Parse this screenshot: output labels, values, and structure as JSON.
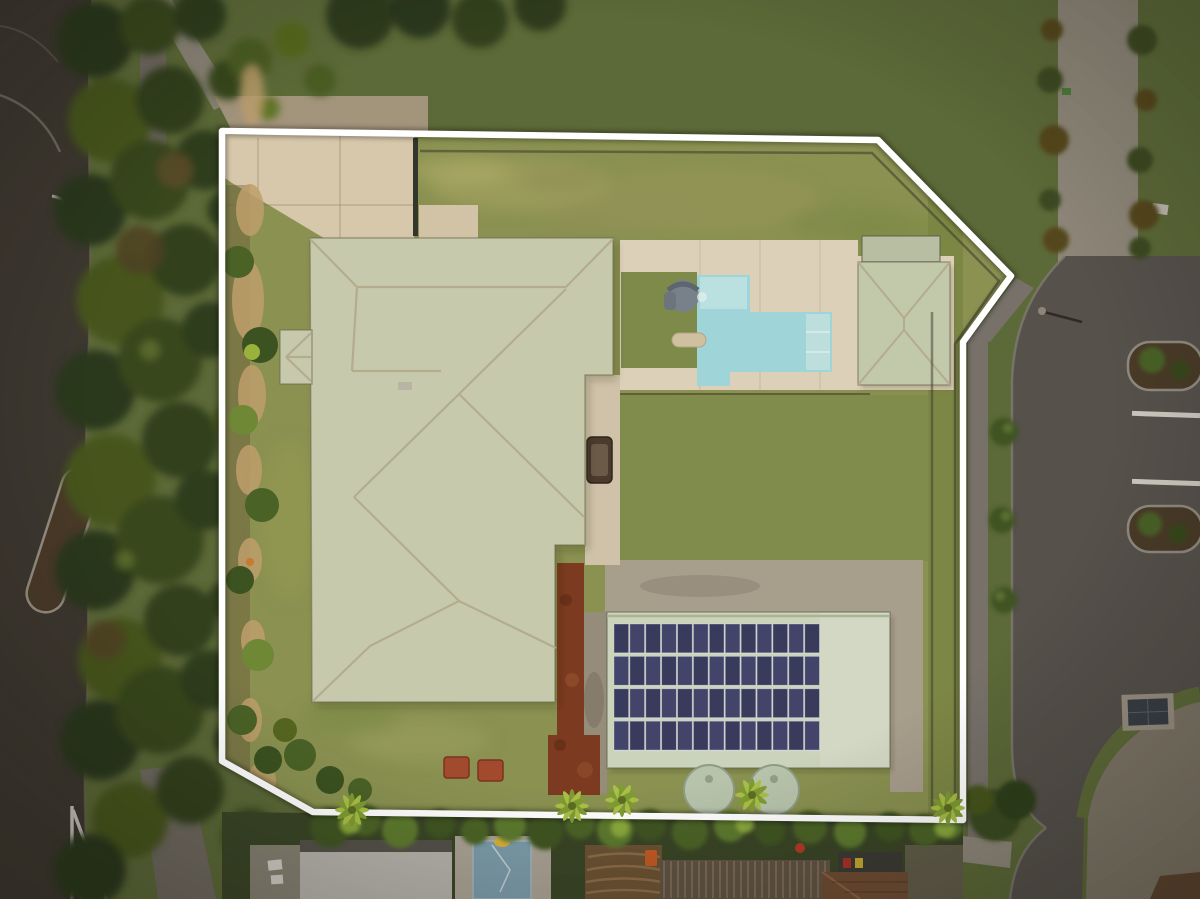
{
  "image": {
    "kind": "aerial-drone-photograph",
    "subject": "residential property with white lot-boundary outline, house with sage hip roof, L-shaped swimming pool, gazebo, shed with rooftop solar array, streets and trees",
    "width_px": 1200,
    "height_px": 899
  },
  "palette": {
    "boundary_line": "#ffffff",
    "road_left": "#3d3830",
    "road_right": "#56514b",
    "footpath": "#6e685f",
    "footpath_right": "#77716a",
    "curb": "#8f897d",
    "grass_outside": "#5c6938",
    "grass_property": "#8a9151",
    "grass_back": "#7f8c4b",
    "grass_verge": "#6d7a42",
    "tree_dark": "#2b371e",
    "tree_mid": "#39471f",
    "shrub_green": "#4a6226",
    "shrub_bright": "#6e8836",
    "mulch_tan": "#bd9f6b",
    "concrete_driveway": "#d7c7ab",
    "concrete_deck": "#ddd0b8",
    "concrete_weathered": "#a89e8c",
    "roof_main": "#c7c9ac",
    "roof_ridge": "#b2a98b",
    "roof_shed": "#ccd3bb",
    "roof_gazebo": "#c2c8aa",
    "pool_water": "#9fd4d8",
    "pool_shallow": "#c3e4e2",
    "solar_panel": "#424469",
    "water_tank": "#b7c3ab",
    "rust_mulch": "#7c3a20",
    "neighbor_pool": "#7d9cab",
    "tile_brown": "#6e4c33"
  },
  "boundary_outline": {
    "color": "#ffffff",
    "points": [
      [
        222,
        131
      ],
      [
        878,
        140
      ],
      [
        1011,
        276
      ],
      [
        963,
        342
      ],
      [
        963,
        820
      ],
      [
        313,
        812
      ],
      [
        222,
        761
      ]
    ]
  },
  "scene_objects": [
    "main-house-roof",
    "porch-roof",
    "front-driveway",
    "front-fence",
    "top-lawn",
    "pool-deck",
    "swimming-pool",
    "pool-slide",
    "sun-lounger",
    "gazebo-roof",
    "shade-structure",
    "back-lawn",
    "garden-bed-left",
    "side-path",
    "bench",
    "rust-garden-strip",
    "shed-roof",
    "solar-array",
    "water-tanks",
    "brick-planters",
    "bottom-hedge",
    "palm-trees",
    "left-road",
    "right-road",
    "median-island",
    "chevron-road-marking",
    "parking-bays",
    "garden-islands",
    "street-trees",
    "neighbor-roof-gray",
    "neighbor-pool",
    "neighbor-deck",
    "pergola-roof",
    "tile-roof",
    "gravel-driveway",
    "streetlight"
  ],
  "counts": {
    "solar_panel_rows": 4,
    "solar_panels_per_row": 13,
    "water_tanks": 2,
    "street_trees_on_verge": 3,
    "parking_bay_lines": 2,
    "landscaped_parking_islands": 2,
    "palm_trees_along_bottom": 5,
    "brick_planters": 2
  }
}
